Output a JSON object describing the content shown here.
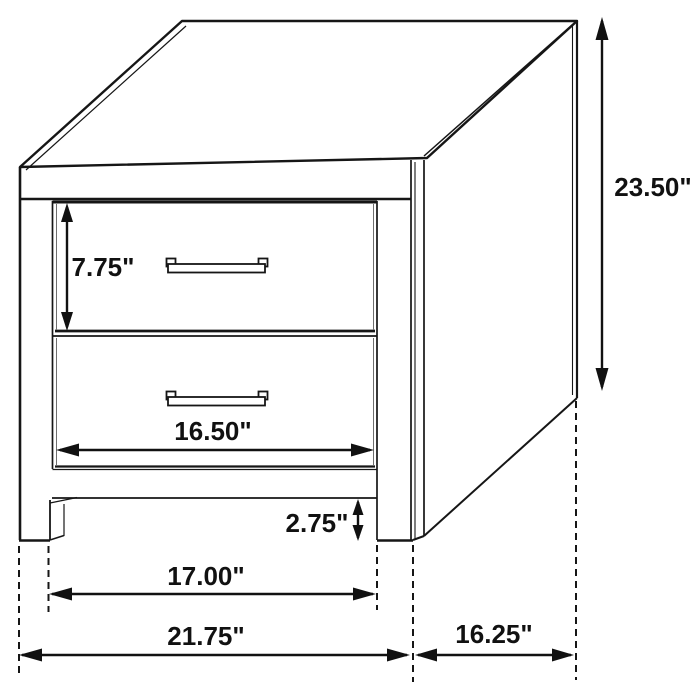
{
  "dimensions": {
    "drawer_height": "7.75\"",
    "overall_height": "23.50\"",
    "drawer_width": "16.50\"",
    "foot_clearance": "2.75\"",
    "inner_width": "17.00\"",
    "overall_width": "21.75\"",
    "overall_depth": "16.25\""
  }
}
